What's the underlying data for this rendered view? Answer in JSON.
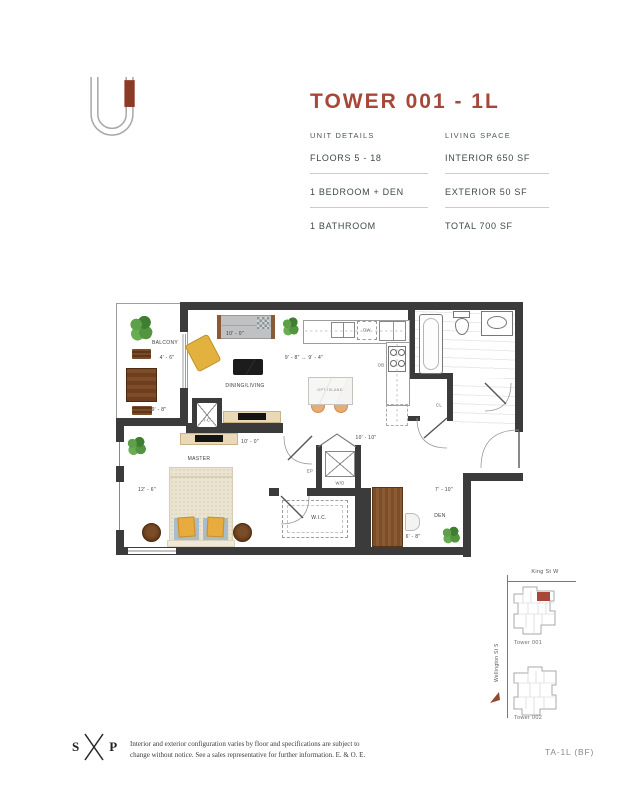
{
  "colors": {
    "accent": "#A6473A",
    "wall": "#3b3b3b",
    "logo_red": "#8C3A26",
    "street": "#b2654a"
  },
  "header": {
    "title": "TOWER 001 - 1L",
    "unit_details": {
      "heading": "UNIT DETAILS",
      "rows": [
        "FLOORS 5 - 18",
        "1 BEDROOM + DEN",
        "1 BATHROOM"
      ]
    },
    "living_space": {
      "heading": "LIVING SPACE",
      "rows": [
        "INTERIOR 650 SF",
        "EXTERIOR 50 SF",
        "TOTAL 700 SF"
      ]
    }
  },
  "floorplan": {
    "labels": {
      "balcony": "BALCONY",
      "dining_living": "DINING/LIVING",
      "opt_island": "OPT ISLAND",
      "master": "MASTER",
      "wic": "W.I.C.",
      "den": "DEN",
      "wd": "W/D",
      "dw": "DW",
      "ob": "OB",
      "ep": "EP",
      "ic": "I-C",
      "cl": "CL"
    },
    "dims": {
      "balcony_width": "4' - 6\"",
      "balcony_length": "9' - 8\"",
      "living_width": "10' - 0\"",
      "kitchen": "9' - 8\" ↔ 9' - 4\"",
      "master_width": "10' - 0\"",
      "master_length": "12' - 6\"",
      "hall": "10' - 10\"",
      "den_width": "7' - 10\"",
      "den_depth": "6' - 8\""
    }
  },
  "sitemap": {
    "street_top": "King St W",
    "street_left": "Wellington St S",
    "tower_1": "Tower 001",
    "tower_2": "Tower 002"
  },
  "footer": {
    "logo_left": "S",
    "logo_right": "P",
    "disclaimer_1": "Interior and exterior configuration varies by floor and specifications are subject to",
    "disclaimer_2": "change without notice. See a sales representative for further information. E. & O. E.",
    "plan_code": "TA-1L (BF)"
  }
}
